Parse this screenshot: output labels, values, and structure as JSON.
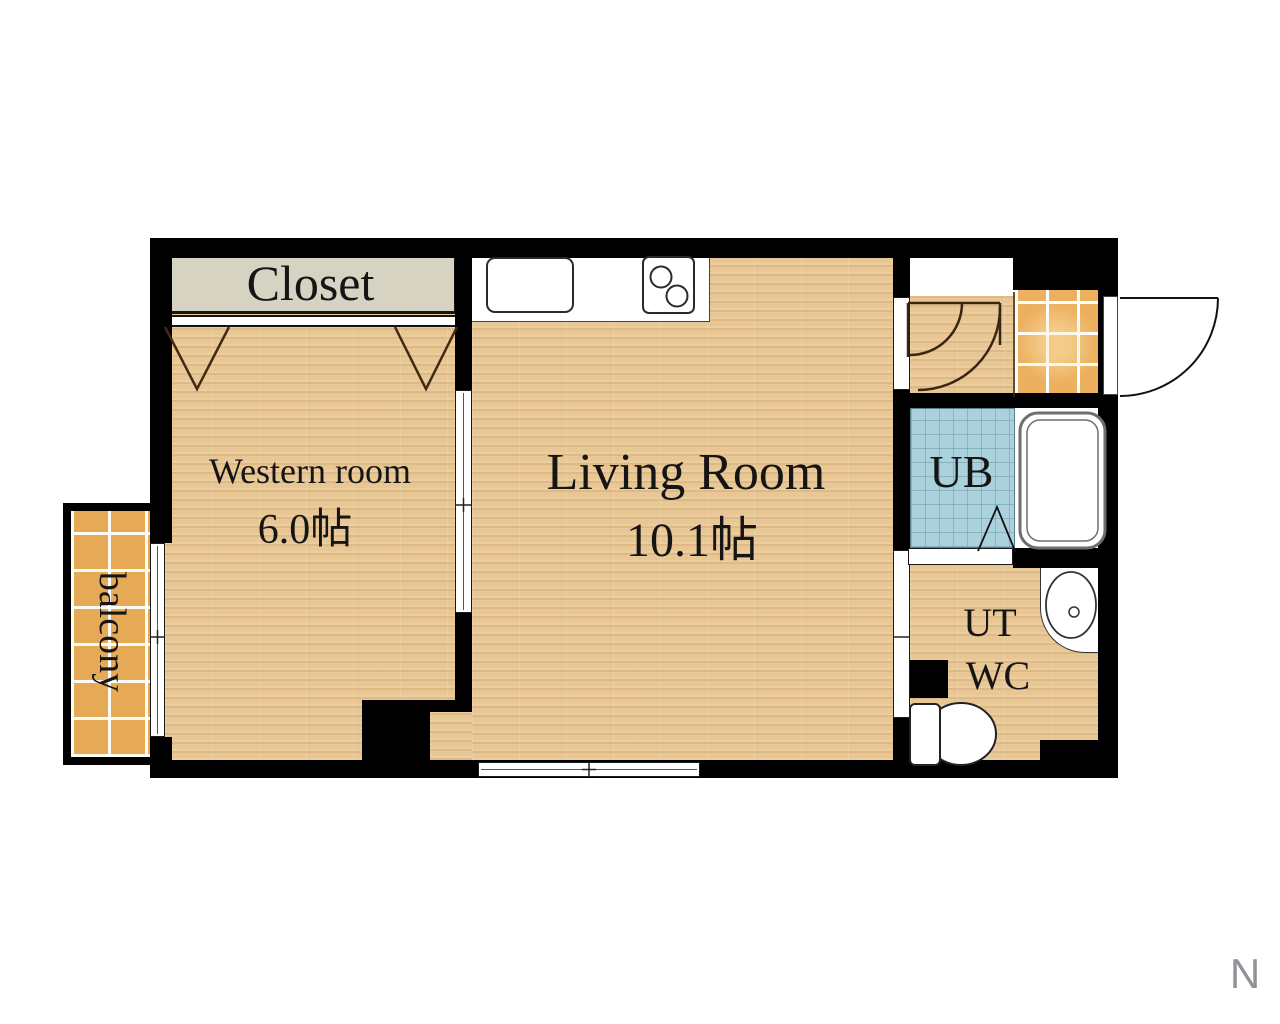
{
  "rooms": {
    "closet": {
      "label": "Closet"
    },
    "western_room": {
      "label": "Western room",
      "size": "6.0帖"
    },
    "living_room": {
      "label": "Living Room",
      "size": "10.1帖"
    },
    "unit_bath": {
      "label": "UB"
    },
    "utility": {
      "label": "UT"
    },
    "toilet_room": {
      "label": "WC"
    },
    "balcony": {
      "label": "balcony"
    }
  },
  "compass": {
    "north_label": "N"
  },
  "colors": {
    "wall": "#000000",
    "wood_floor": "#e8c795",
    "entry_tile": "#ecb05e",
    "balcony_tile": "#e6aa56",
    "bath_tile": "#abd1dd",
    "closet_fill": "#d6d3c2",
    "background": "#ffffff",
    "line_brown": "#3f2a12"
  },
  "fixtures": {
    "kitchen_sink": "sink-icon",
    "stove": "stove-icon",
    "bathtub": "bathtub-icon",
    "washbasin": "washbasin-icon",
    "toilet": "toilet-icon",
    "entry_door": "door-swing-icon",
    "hall_storage_doors": "door-swing-icon",
    "closet_doors": "folding-door-icon",
    "bath_door": "folding-door-icon",
    "windows": "sliding-window-icon"
  }
}
